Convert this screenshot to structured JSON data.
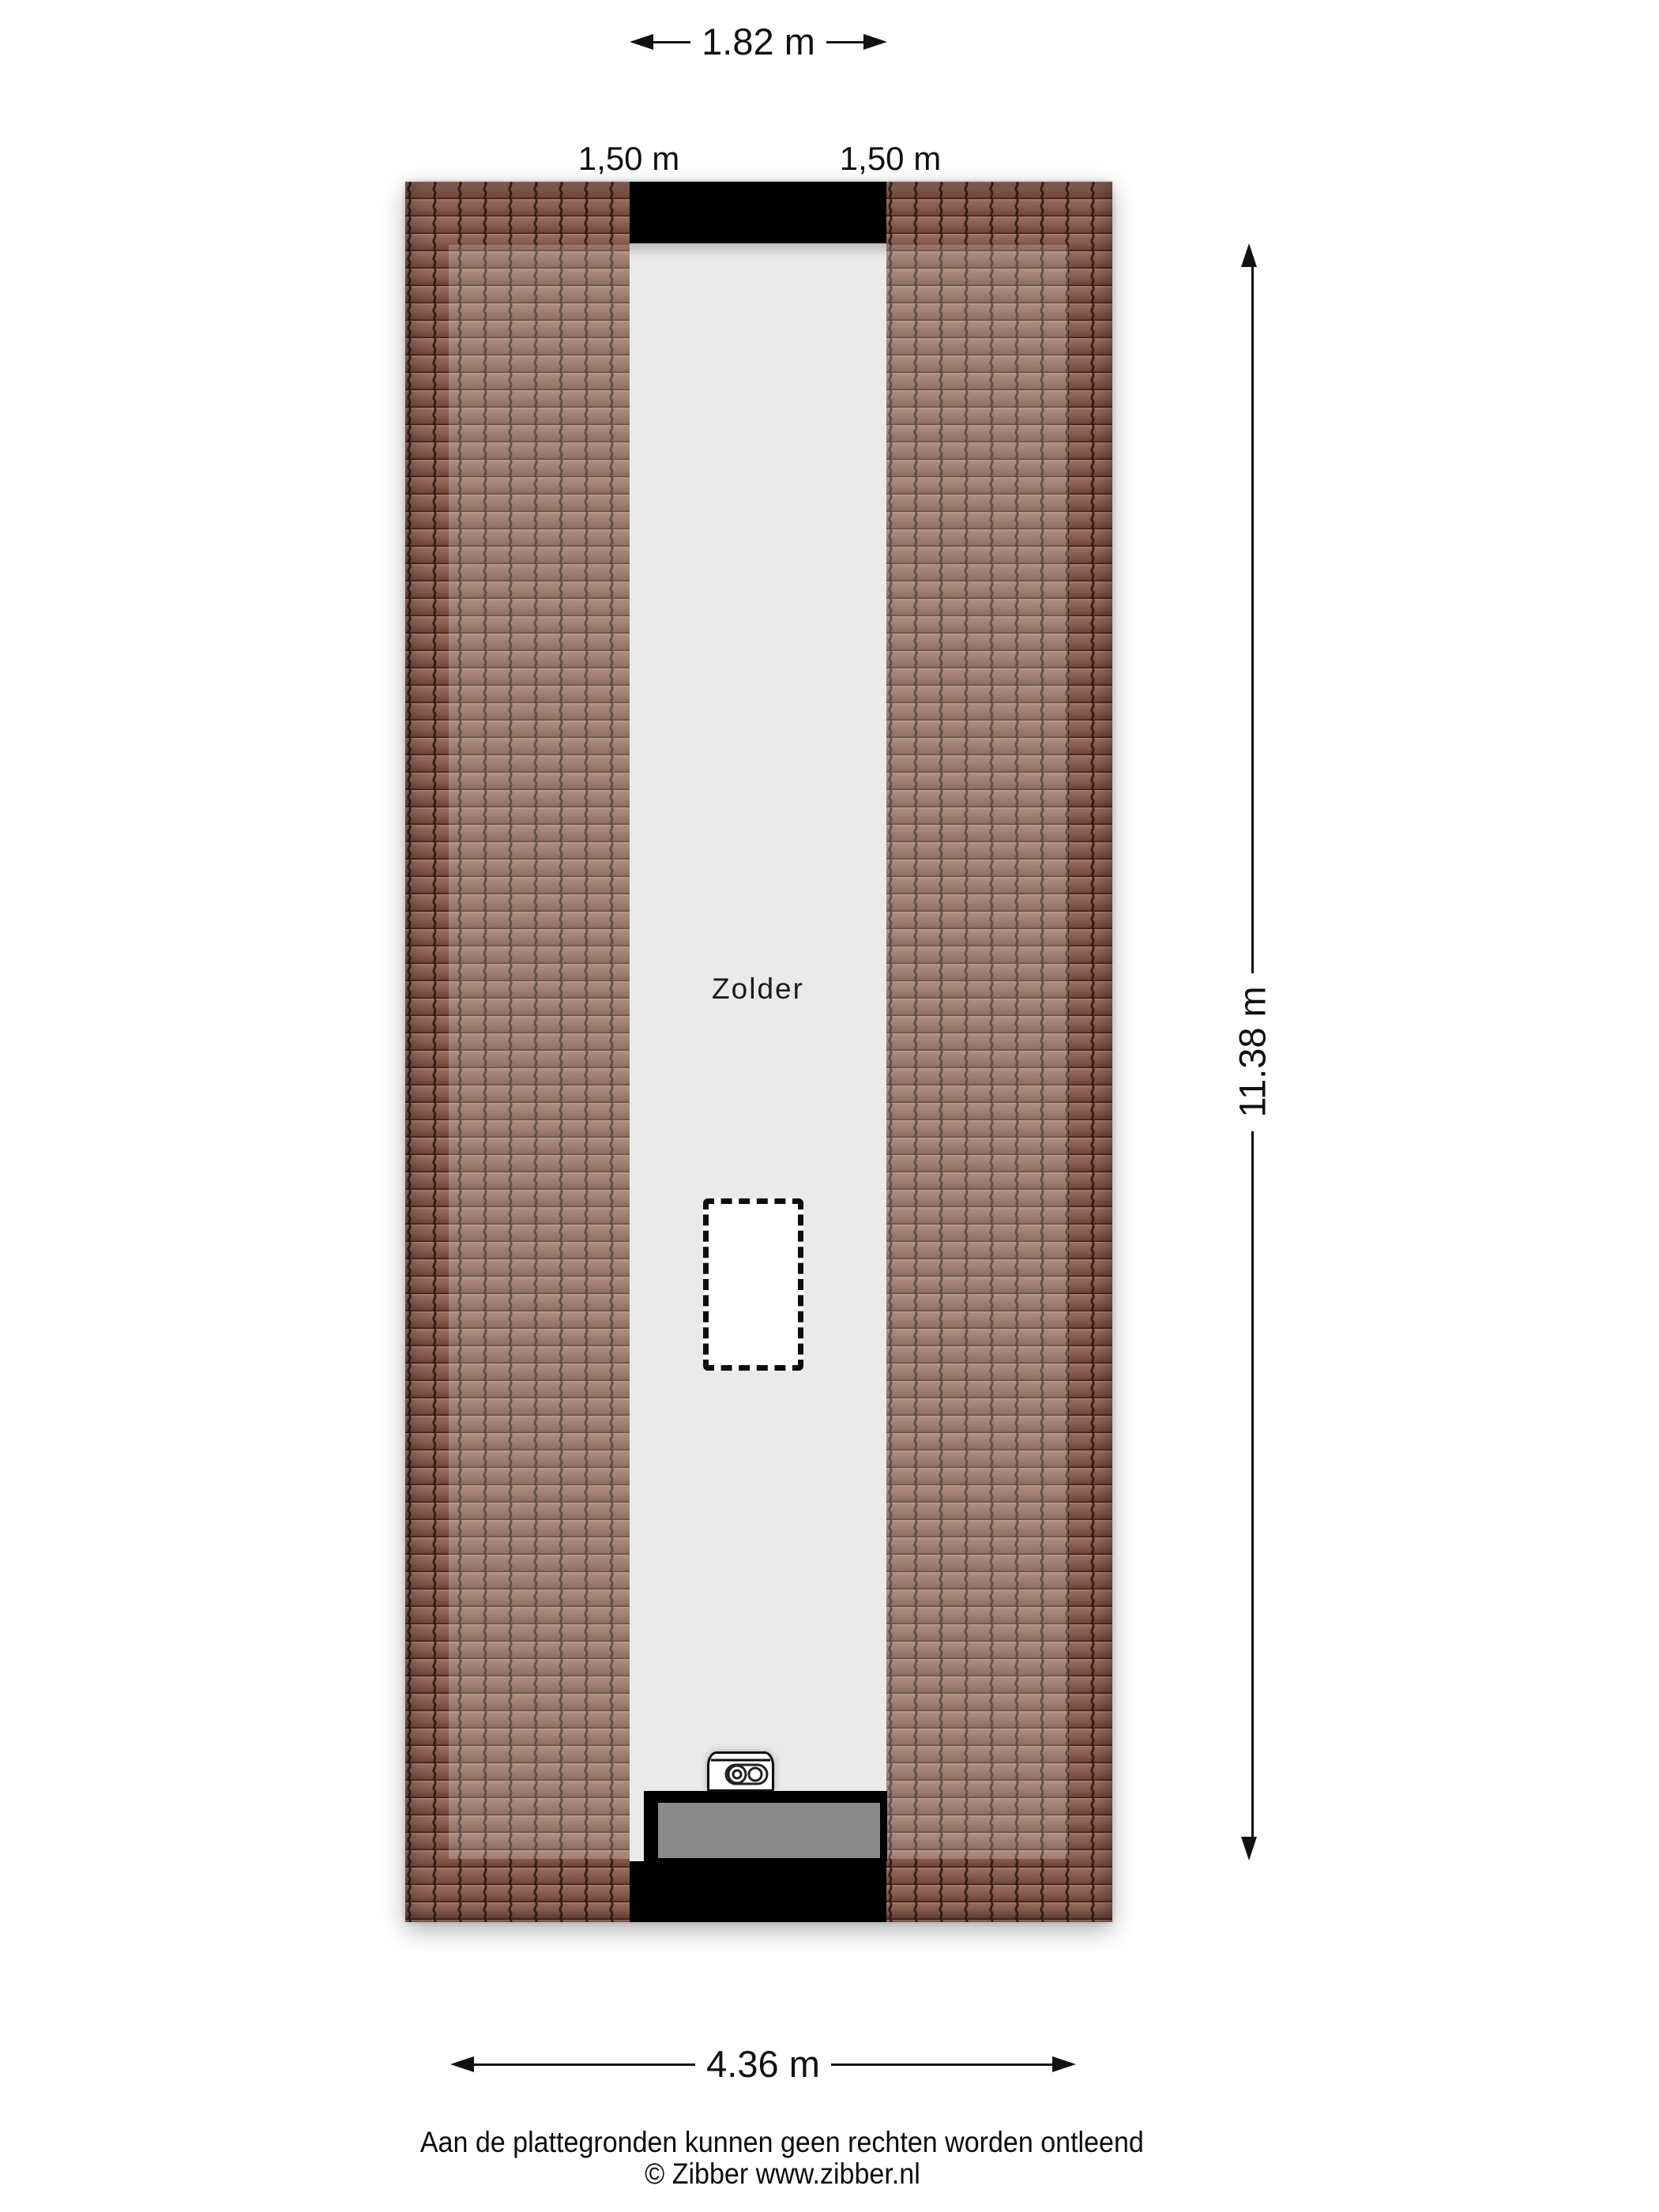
{
  "dimensions": {
    "top": "1.82 m",
    "left_eave": "1,50 m",
    "right_eave": "1,50 m",
    "height": "11.38 m",
    "bottom": "4.36 m"
  },
  "room": {
    "label": "Zolder"
  },
  "footer": {
    "disclaimer": "Aan de plattegronden kunnen geen rechten worden ontleend",
    "credit": "© Zibber www.zibber.nl"
  },
  "icons": {
    "boiler": "boiler-icon",
    "arrows": [
      "arrowhead-left-icon",
      "arrowhead-right-icon",
      "arrowhead-up-icon",
      "arrowhead-down-icon"
    ]
  },
  "colors": {
    "roof_tile_base": "#84594a",
    "roof_tile_light": "#9a7060",
    "roof_tile_dark": "#6b4234",
    "roof_tile_line": "#241208",
    "highlight_overlay": "rgba(255,255,255,0.22)",
    "floor": "#eaeaea",
    "structure_black": "#000000",
    "dormer_glass": "#8a8a8a",
    "dimension_ink": "#111111"
  }
}
